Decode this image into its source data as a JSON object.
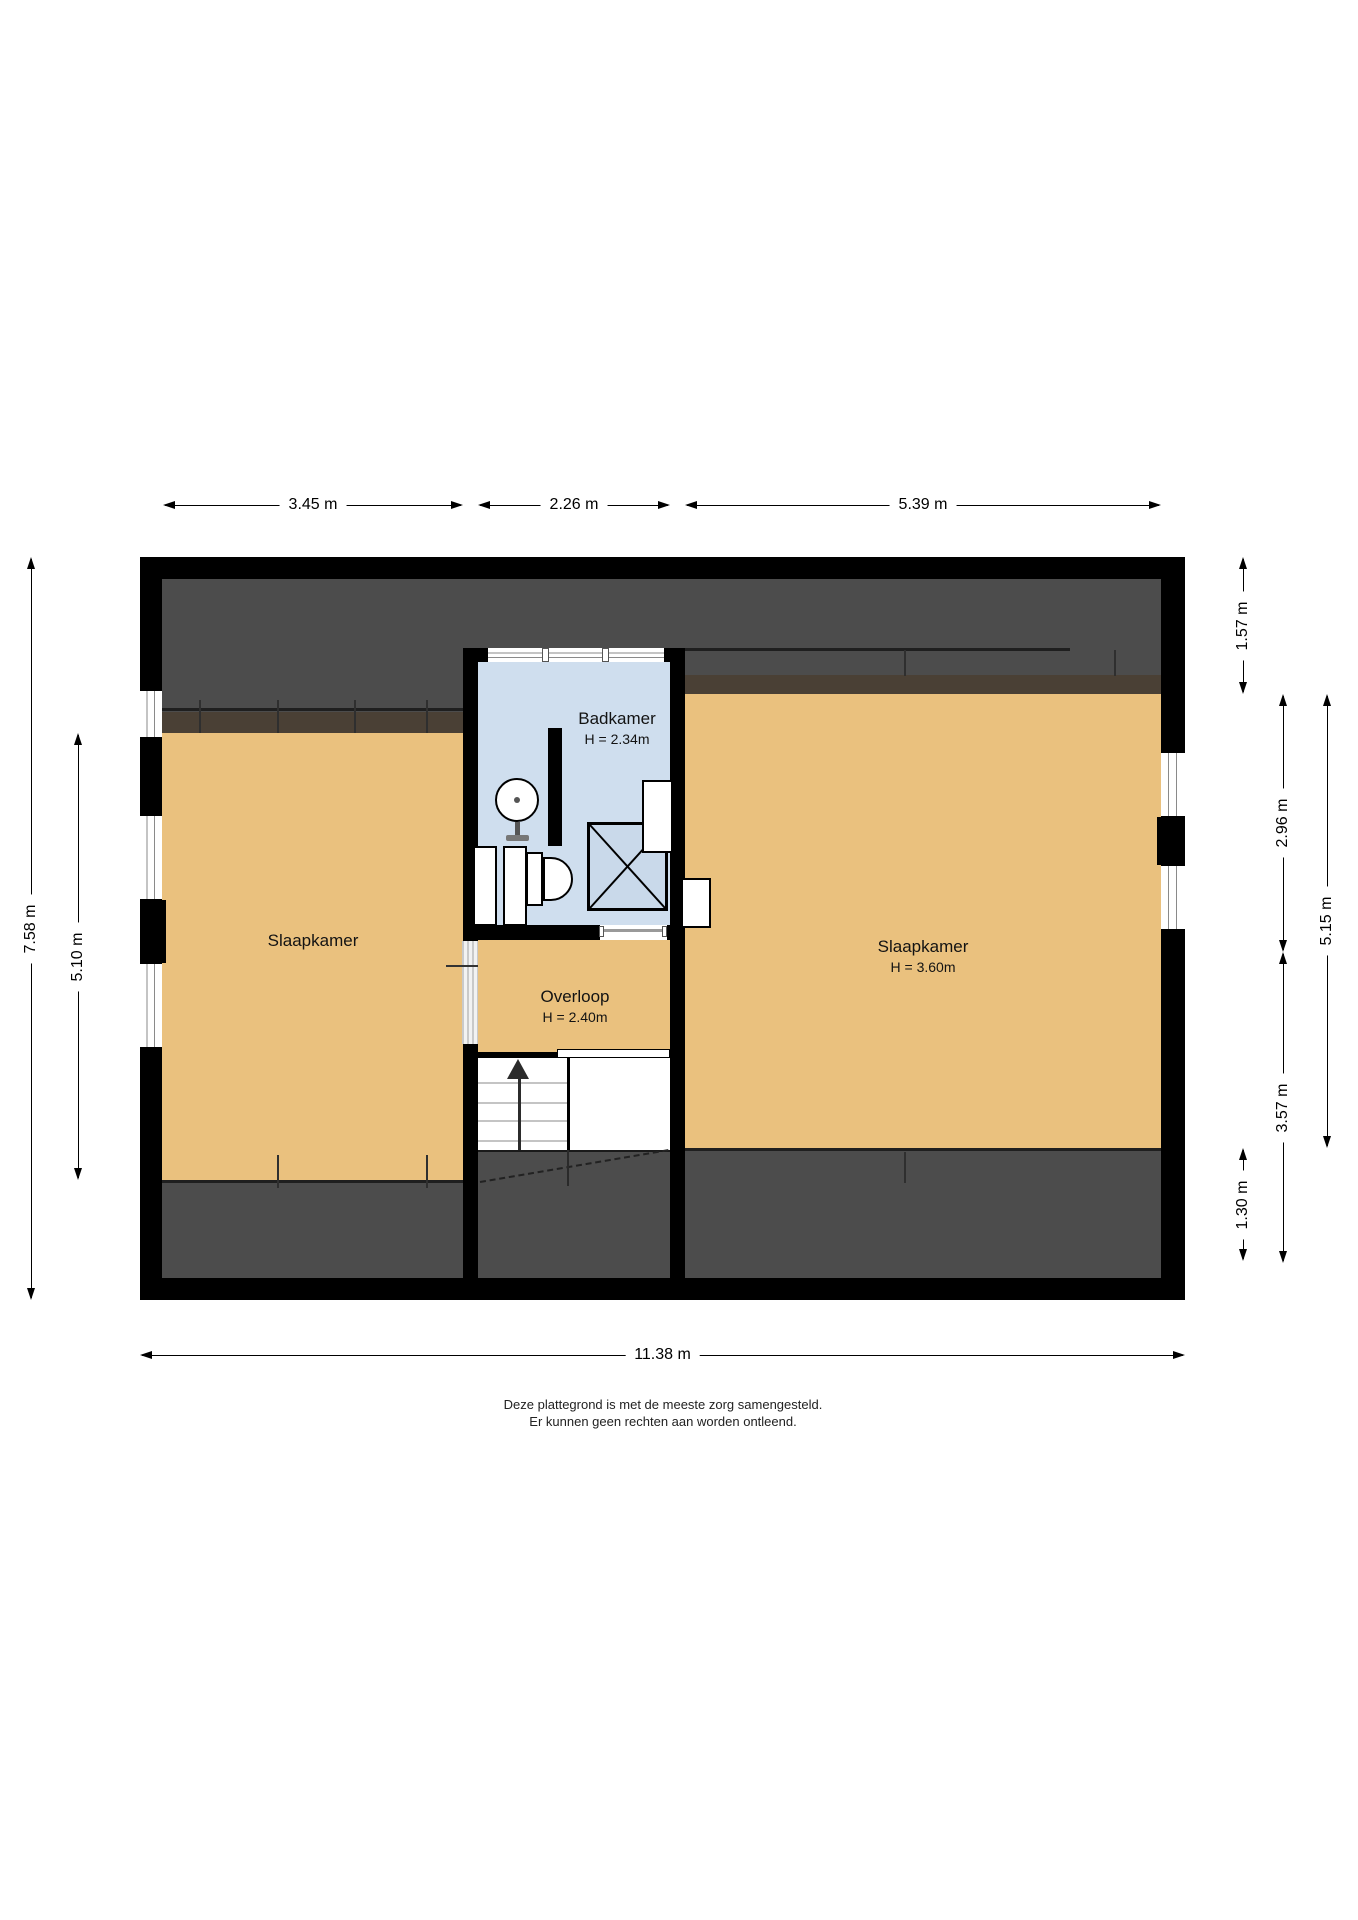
{
  "plan": {
    "rooms": {
      "badkamer": {
        "label": "Badkamer",
        "height": "H = 2.34m"
      },
      "overloop": {
        "label": "Overloop",
        "height": "H = 2.40m"
      },
      "slaapkamer_left": {
        "label": "Slaapkamer"
      },
      "slaapkamer_right": {
        "label": "Slaapkamer",
        "height": "H = 3.60m"
      }
    },
    "dimensions": {
      "top": [
        {
          "label": "3.45 m"
        },
        {
          "label": "2.26 m"
        },
        {
          "label": "5.39 m"
        }
      ],
      "bottom": {
        "label": "11.38 m"
      },
      "left_outer": {
        "label": "7.58 m"
      },
      "left_inner": {
        "label": "5.10 m"
      },
      "right": [
        {
          "label": "1.57 m"
        },
        {
          "label": "2.96 m"
        },
        {
          "label": "3.57 m"
        },
        {
          "label": "1.30 m"
        },
        {
          "label": "5.15 m"
        }
      ]
    },
    "caption": [
      "Deze plattegrond is met de meeste zorg samengesteld.",
      "Er kunnen geen rechten aan worden ontleend."
    ],
    "colors": {
      "wall": "#000000",
      "floor": "#eac17e",
      "bathroom_floor": "#cfdeee",
      "roof_area": "#4c4c4c",
      "knee_strip": "#4a4035"
    },
    "symbols": {
      "sink": "circle-basin-on-pedestal",
      "toilet": "tank-and-bowl",
      "shower": "crossed-square",
      "stairs": "treads-with-up-arrow",
      "window": "triple-line-glazing"
    }
  }
}
